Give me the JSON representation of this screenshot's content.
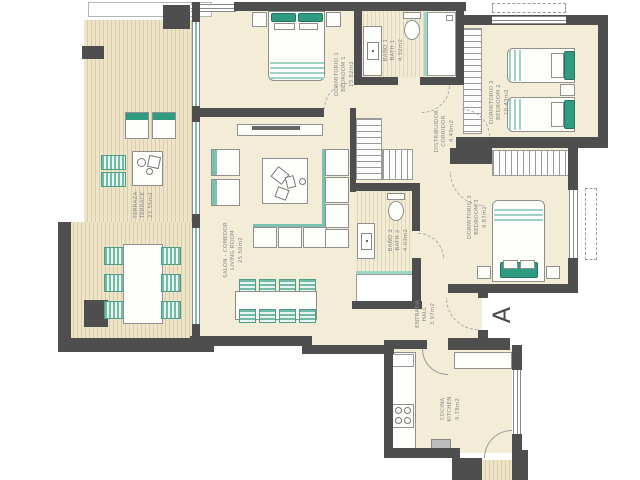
{
  "marker_a": "A",
  "rooms": {
    "terrace": {
      "name_es": "TERRAZA",
      "name_en": "TERRACE",
      "area": "23.55m2"
    },
    "bedroom1": {
      "name_es": "DORMITORIO 1",
      "name_en": "BEDROOM 1",
      "area": "13.82m2"
    },
    "bath1": {
      "name_es": "BAÑO 1",
      "name_en": "BATH 1",
      "area": "4.32m2"
    },
    "bedroom2": {
      "name_es": "DORMITORIO 2",
      "name_en": "BEDROOM 2",
      "area": "10.43m2"
    },
    "corridor": {
      "name_es": "DISTRIBUIDOR",
      "name_en": "CORRIDOR",
      "area": "4.49m2"
    },
    "bedroom3": {
      "name_es": "DORMITORIO 3",
      "name_en": "BEDROOM 3",
      "area": "9.87m2"
    },
    "bath2": {
      "name_es": "BAÑO 2",
      "name_en": "BATH 2",
      "area": "4.03m2"
    },
    "living": {
      "name_es": "SALON - COMEDOR",
      "name_en": "LIVING ROOM",
      "area": "25.50m2"
    },
    "hall": {
      "name_es": "ENTRADA",
      "name_en": "HALL",
      "area": "3.97m2"
    },
    "kitchen": {
      "name_es": "COCINA",
      "name_en": "KITCHEN",
      "area": "9.78m2"
    }
  },
  "colors": {
    "wall": "#4e4e4e",
    "floor": "#f3edd8",
    "accent_teal": "#2f9b80",
    "glass": "#9ad7c8",
    "label_text": "#8a8a8a"
  }
}
